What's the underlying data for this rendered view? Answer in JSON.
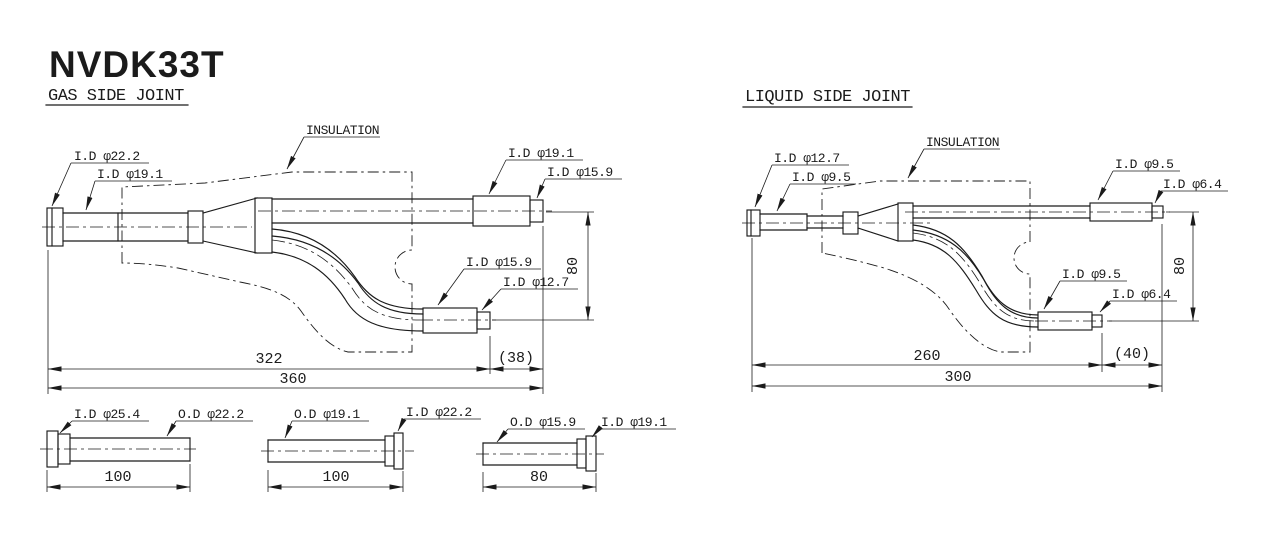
{
  "page": {
    "title": "NVDK33T"
  },
  "gas": {
    "heading": "GAS SIDE JOINT",
    "insulation": "INSULATION",
    "labels": {
      "inlet_outer": "I.D φ22.2",
      "inlet_inner": "I.D φ19.1",
      "outlet_top_outer": "I.D φ19.1",
      "outlet_top_inner": "I.D φ15.9",
      "outlet_bottom_outer": "I.D φ15.9",
      "outlet_bottom_inner": "I.D φ12.7"
    },
    "dims": {
      "main": "322",
      "stub": "(38)",
      "overall": "360",
      "offset": "80"
    }
  },
  "liquid": {
    "heading": "LIQUID SIDE JOINT",
    "insulation": "INSULATION",
    "labels": {
      "inlet_outer": "I.D φ12.7",
      "inlet_inner": "I.D φ9.5",
      "outlet_top_outer": "I.D φ9.5",
      "outlet_top_inner": "I.D φ6.4",
      "outlet_bottom_outer": "I.D φ9.5",
      "outlet_bottom_inner": "I.D φ6.4"
    },
    "dims": {
      "main": "260",
      "stub": "(40)",
      "overall": "300",
      "offset": "80"
    }
  },
  "sleeves": [
    {
      "label_a": "I.D φ25.4",
      "label_b": "O.D φ22.2",
      "length": "100"
    },
    {
      "label_a": "O.D φ19.1",
      "label_b": "I.D φ22.2",
      "length": "100"
    },
    {
      "label_a": "O.D φ15.9",
      "label_b": "I.D φ19.1",
      "length": "80"
    }
  ]
}
